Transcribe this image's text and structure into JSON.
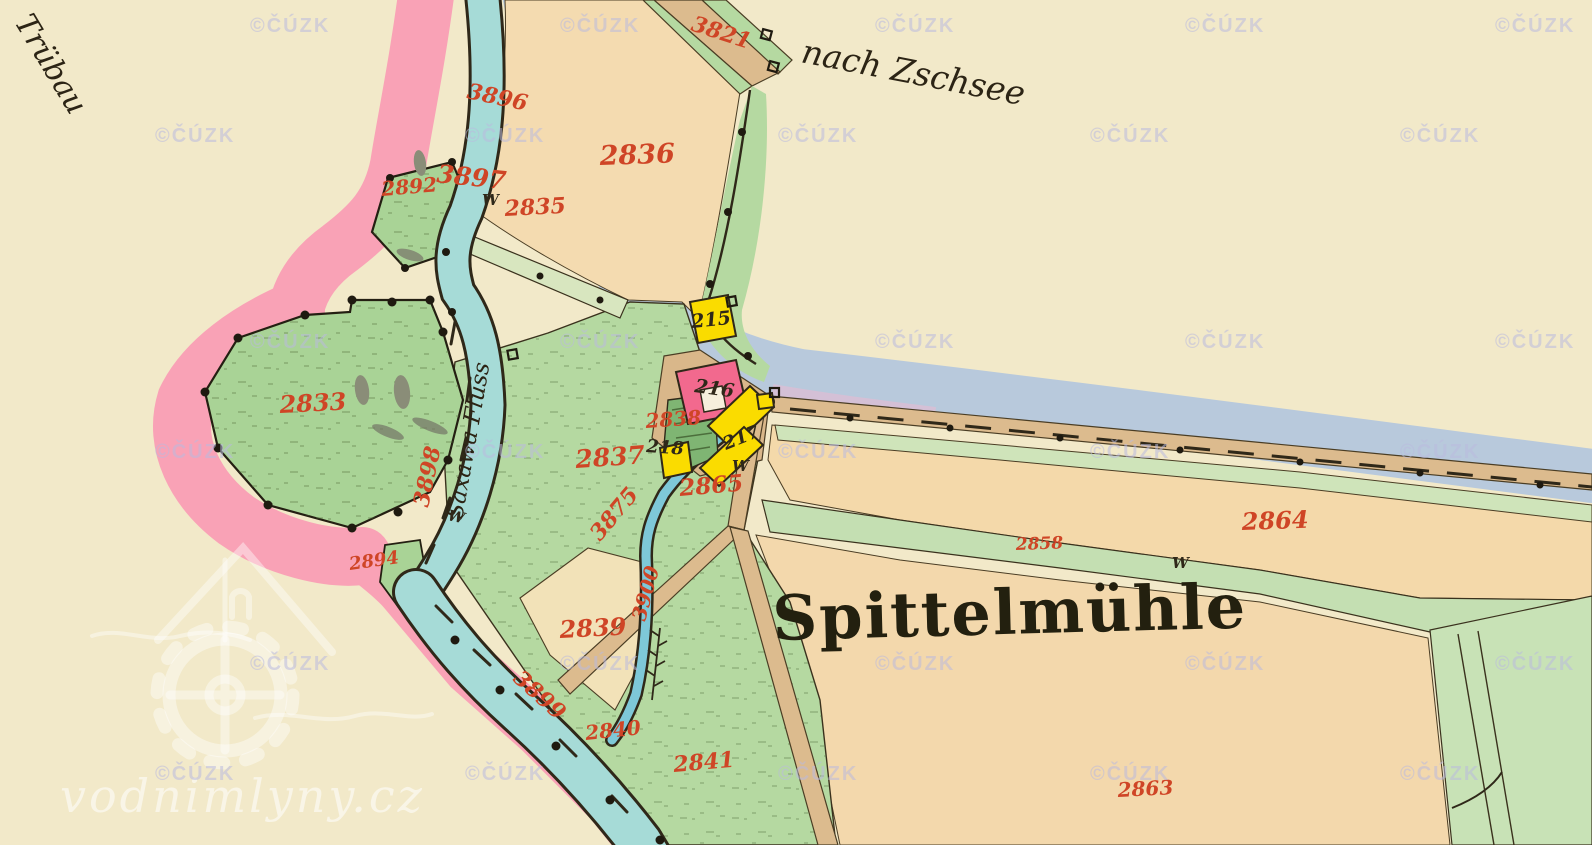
{
  "map_labels": {
    "settlement": "Spittelmühle",
    "route_ne": "nach Zschsee",
    "route_nw": "Trübau",
    "river": "Saxawa Fluss",
    "meadow_symbol": "W"
  },
  "parcel_numbers": [
    {
      "text": "3821",
      "x": 690,
      "y": 30,
      "rot": 18,
      "size": 22
    },
    {
      "text": "3896",
      "x": 466,
      "y": 98,
      "rot": 12,
      "size": 22
    },
    {
      "text": "2836",
      "x": 600,
      "y": 165,
      "rot": -2,
      "size": 27
    },
    {
      "text": "3897",
      "x": 436,
      "y": 182,
      "rot": 6,
      "size": 25
    },
    {
      "text": "2892",
      "x": 382,
      "y": 196,
      "rot": -5,
      "size": 20
    },
    {
      "text": "2835",
      "x": 505,
      "y": 216,
      "rot": -3,
      "size": 22
    },
    {
      "text": "2833",
      "x": 280,
      "y": 413,
      "rot": -3,
      "size": 24
    },
    {
      "text": "3898",
      "x": 428,
      "y": 508,
      "rot": -78,
      "size": 22
    },
    {
      "text": "2894",
      "x": 350,
      "y": 570,
      "rot": -8,
      "size": 18
    },
    {
      "text": "2837",
      "x": 576,
      "y": 468,
      "rot": -4,
      "size": 25
    },
    {
      "text": "3875",
      "x": 600,
      "y": 542,
      "rot": -50,
      "size": 22
    },
    {
      "text": "2838",
      "x": 646,
      "y": 428,
      "rot": -4,
      "size": 20
    },
    {
      "text": "2865",
      "x": 680,
      "y": 496,
      "rot": -5,
      "size": 23
    },
    {
      "text": "2858",
      "x": 1016,
      "y": 550,
      "rot": -2,
      "size": 17
    },
    {
      "text": "2864",
      "x": 1242,
      "y": 530,
      "rot": -2,
      "size": 24
    },
    {
      "text": "2839",
      "x": 560,
      "y": 638,
      "rot": -3,
      "size": 24
    },
    {
      "text": "3899",
      "x": 512,
      "y": 680,
      "rot": 42,
      "size": 22
    },
    {
      "text": "2840",
      "x": 586,
      "y": 740,
      "rot": -6,
      "size": 20
    },
    {
      "text": "3900",
      "x": 645,
      "y": 622,
      "rot": -75,
      "size": 20
    },
    {
      "text": "2841",
      "x": 674,
      "y": 772,
      "rot": -5,
      "size": 22
    },
    {
      "text": "2863",
      "x": 1118,
      "y": 797,
      "rot": -3,
      "size": 20
    }
  ],
  "building_numbers": [
    {
      "text": "215",
      "x": 692,
      "y": 328,
      "rot": -6,
      "size": 19
    },
    {
      "text": "216",
      "x": 694,
      "y": 392,
      "rot": 8,
      "size": 19
    },
    {
      "text": "218",
      "x": 646,
      "y": 452,
      "rot": 4,
      "size": 18
    },
    {
      "text": "217",
      "x": 726,
      "y": 450,
      "rot": -22,
      "size": 18
    }
  ],
  "meadow_marks": [
    {
      "x": 482,
      "y": 205,
      "rot": 0
    },
    {
      "x": 447,
      "y": 520,
      "rot": 12
    },
    {
      "x": 732,
      "y": 471,
      "rot": 0
    },
    {
      "x": 1172,
      "y": 568,
      "rot": 0
    }
  ],
  "watermark": {
    "text": "©ČÚZK",
    "rows": [
      {
        "y": 32,
        "xs": [
          250,
          560,
          875,
          1185,
          1495
        ]
      },
      {
        "y": 142,
        "xs": [
          155,
          465,
          778,
          1090,
          1400
        ]
      },
      {
        "y": 348,
        "xs": [
          250,
          560,
          875,
          1185,
          1495
        ]
      },
      {
        "y": 458,
        "xs": [
          155,
          465,
          778,
          1090,
          1400
        ]
      },
      {
        "y": 670,
        "xs": [
          250,
          560,
          875,
          1185,
          1495
        ]
      },
      {
        "y": 780,
        "xs": [
          155,
          465,
          778,
          1090,
          1400
        ]
      }
    ]
  },
  "branding": {
    "site": "vodnimlyny.cz"
  },
  "colors": {
    "paper": "#f2e9c9",
    "field_tan": "#f4dbb0",
    "meadow_green": "#b5d9a1",
    "river_cyan": "#a6dbd7",
    "water_band_blue": "#b8c9dc",
    "sheet_edge_pink": "#f9a2b6",
    "building_wood_yellow": "#fadc00",
    "building_masonry_pink": "#f2698e",
    "road_tan": "#dcbb8e",
    "parcel_label_red": "#cf4526",
    "ink_black": "#2f2819",
    "watermark_lavender": "#bbbade"
  }
}
